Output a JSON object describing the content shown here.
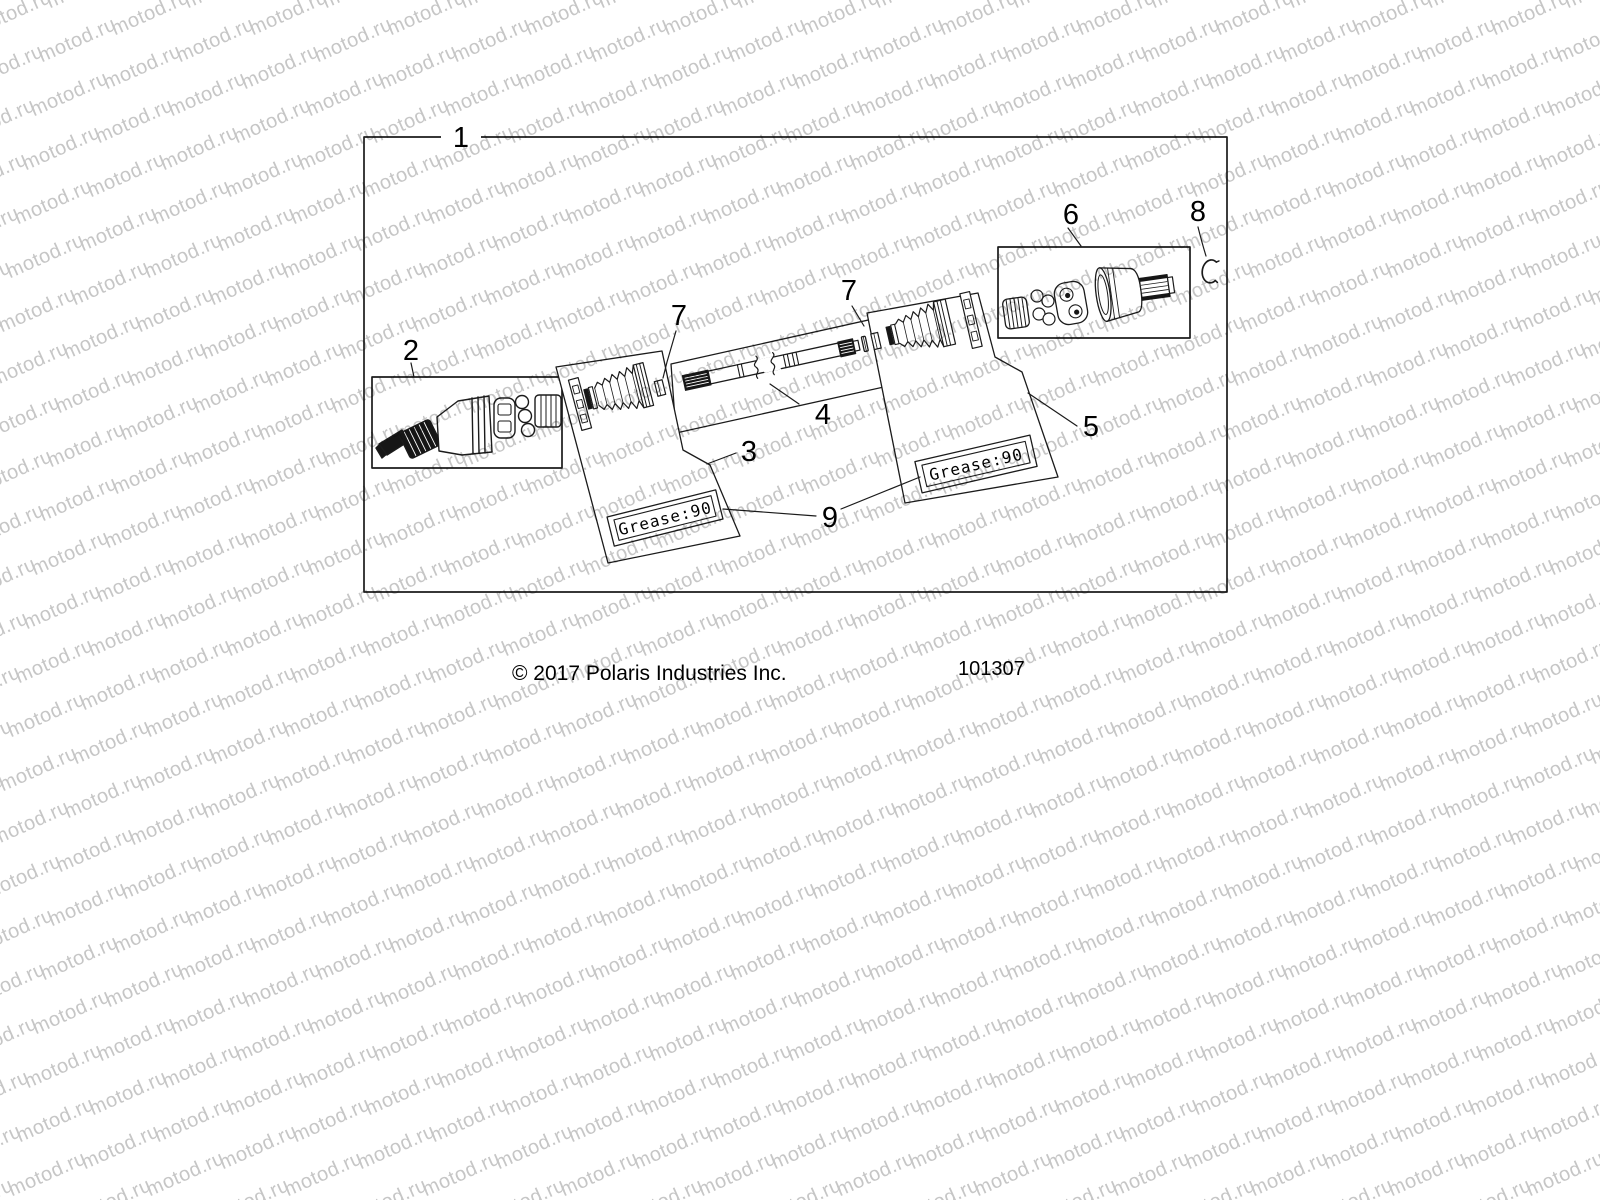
{
  "watermark": {
    "text": "motod.ru",
    "color": "#c6c6c6"
  },
  "figure": {
    "callouts": {
      "c1": "1",
      "c2": "2",
      "c3": "3",
      "c4": "4",
      "c5": "5",
      "c6": "6",
      "c7_left": "7",
      "c7_right": "7",
      "c8": "8",
      "c9": "9"
    },
    "grease_label_left": "Grease:90",
    "grease_label_right": "Grease:90",
    "footer": {
      "copyright": "© 2017 Polaris Industries Inc.",
      "drawing_number": "101307"
    }
  }
}
